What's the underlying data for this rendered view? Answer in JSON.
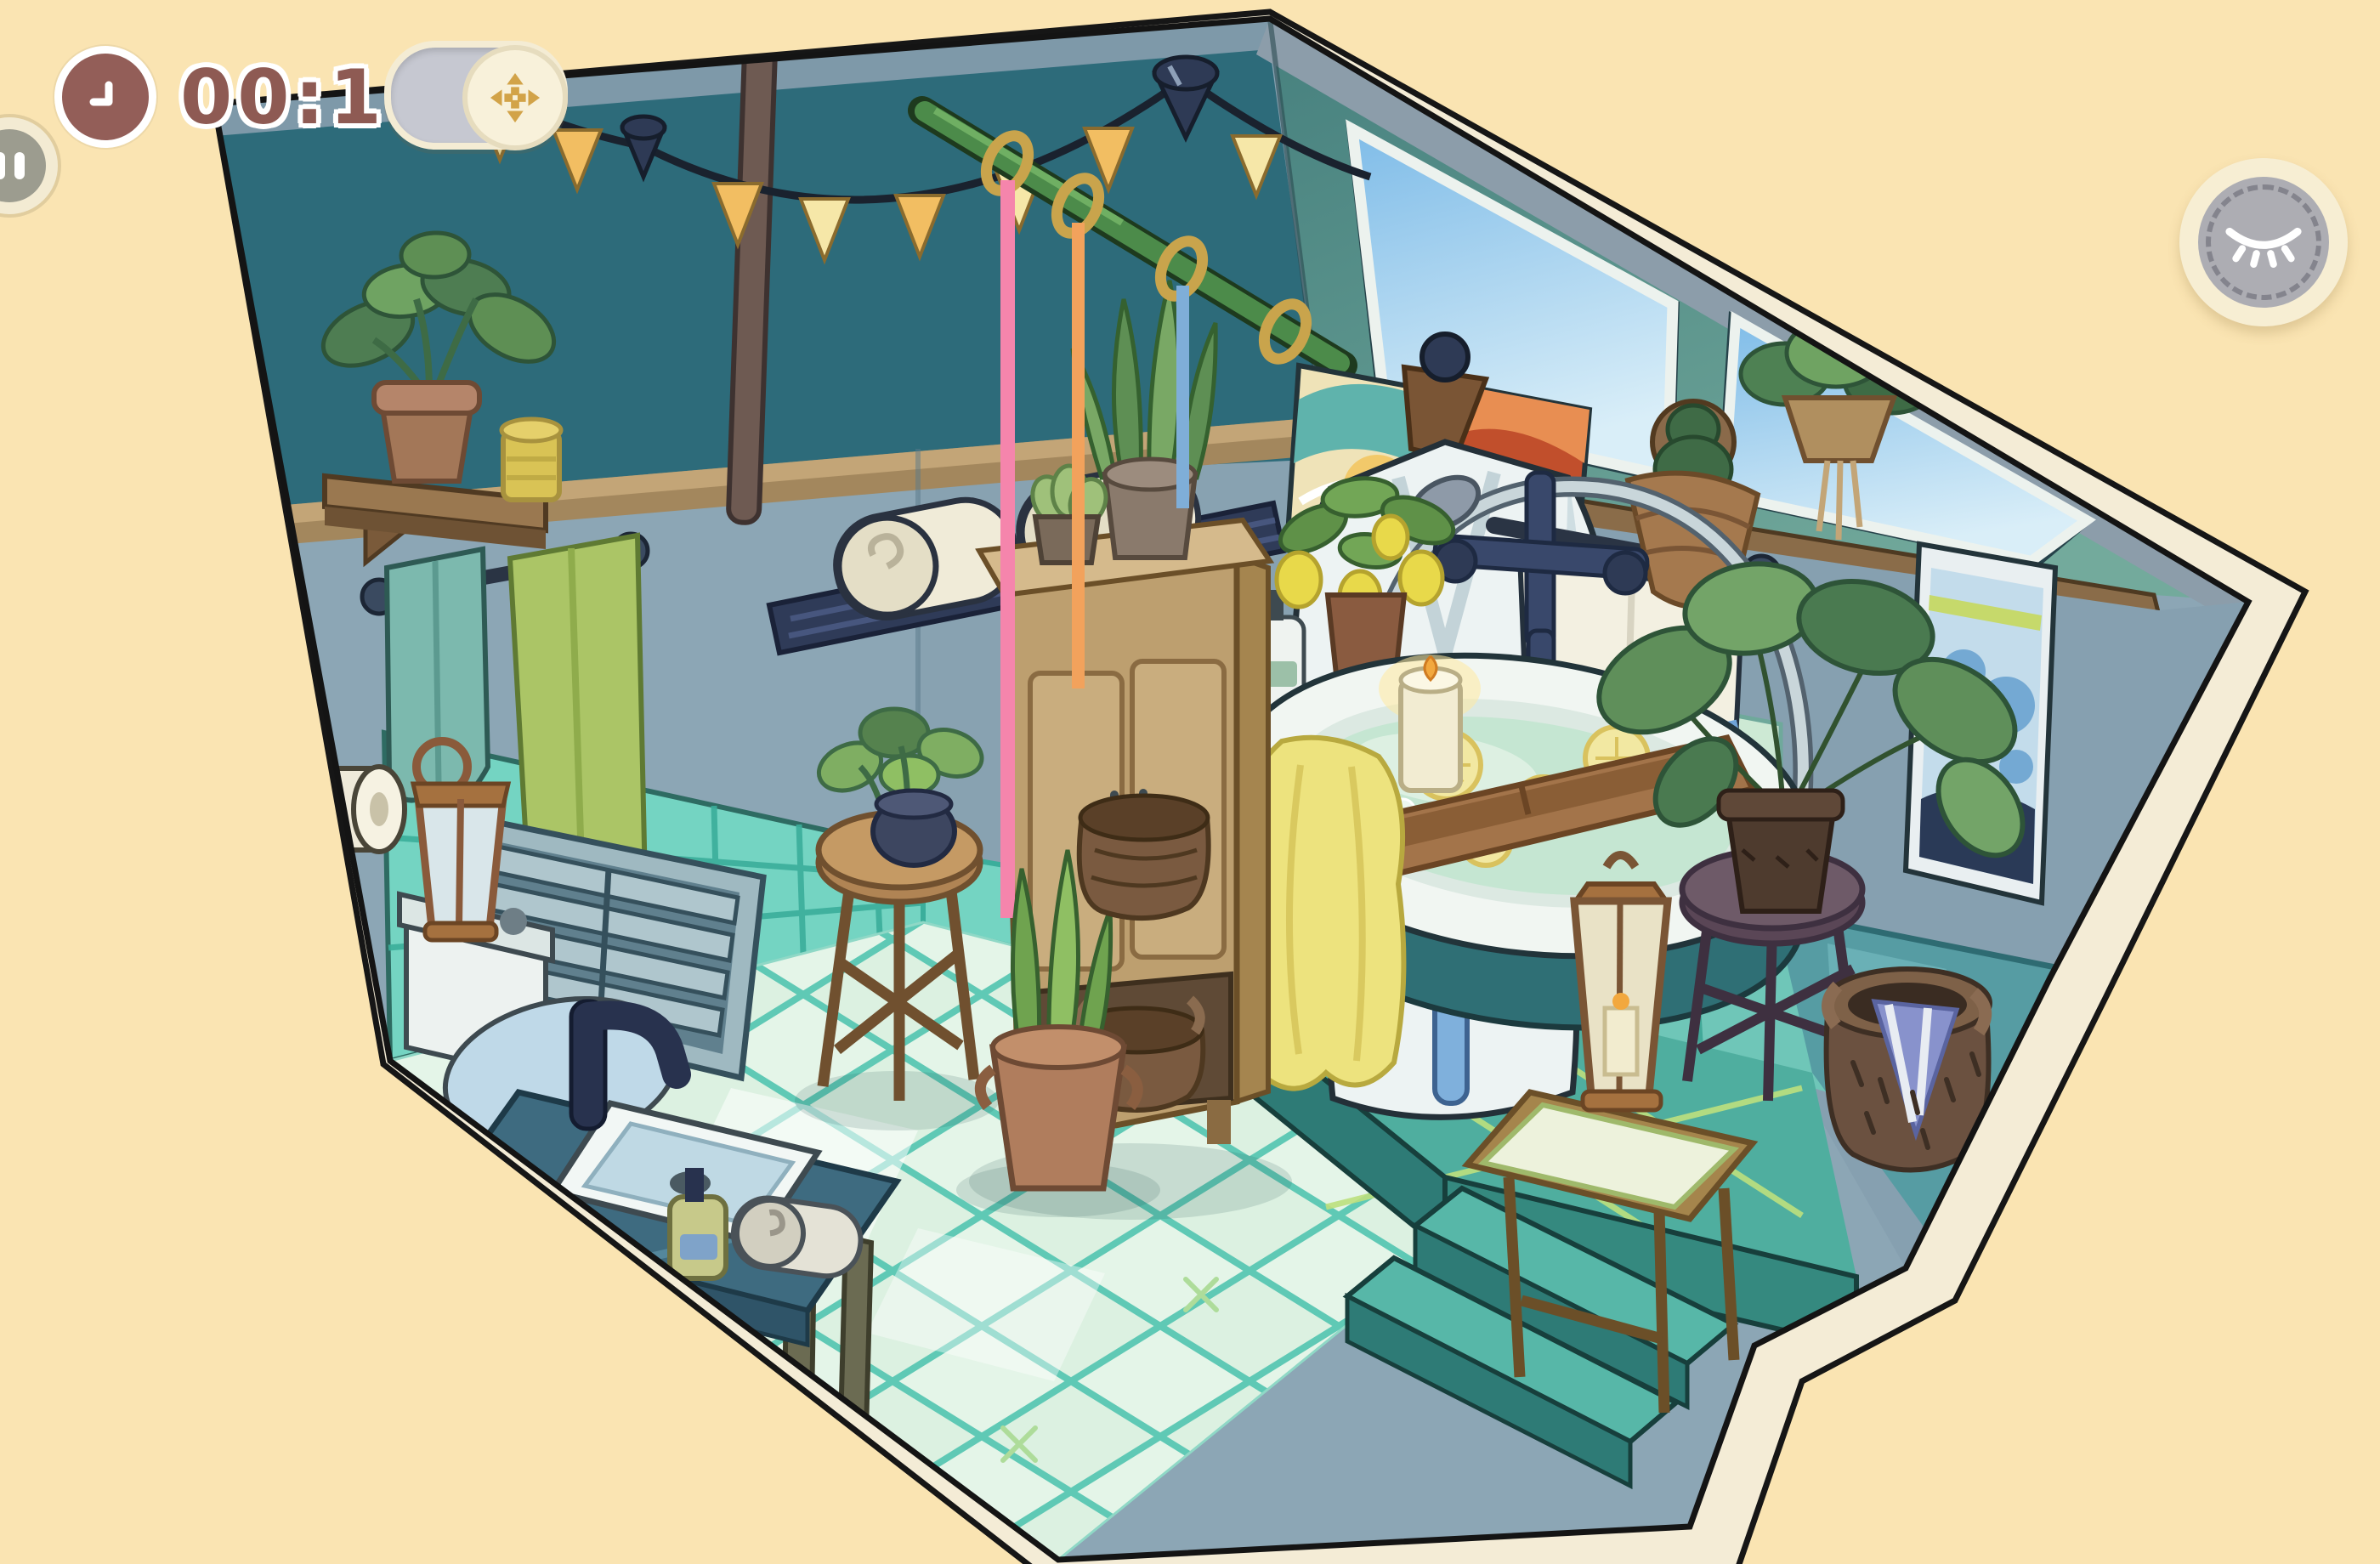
{
  "hud": {
    "timer": {
      "label": "00:18",
      "icon": "clock-icon"
    },
    "move_toggle": {
      "icon": "move-arrows-icon",
      "state_on": true
    },
    "pause_button": {
      "icon": "pause-icon"
    },
    "hide_button": {
      "icon": "closed-eye-icon"
    }
  },
  "scene": {
    "name": "attic-bathroom-room",
    "background_color": "#FAE4B2",
    "room_border_color": "#F4ECD6",
    "palette": {
      "wall_upper_teal": "#2D6B7A",
      "wall_top_strip": "#7E99A9",
      "wall_lower_bluegrey": "#8CA6B5",
      "molding_tan": "#A3875D",
      "ceiling_slope_teal": "#4F8A86",
      "roof_band_grey": "#8C9DAA",
      "skylight_sky_blue": "#9CCDEE",
      "beam_brown": "#8A6C49",
      "wainscot_tile_teal": "#74D4C2",
      "floor_mint": "#DCF1E1",
      "floor_grout": "#5FC9B5",
      "platform_teal": "#4FAE9F",
      "platform_front_dark": "#2E7B76",
      "ribbon_pink": "#F585AC",
      "ribbon_orange": "#F2A25C",
      "ribbon_blue": "#7FAED8",
      "flag_gold": "#F2BE62",
      "flag_cream": "#F6E7A8",
      "towel_yellow": "#EDE37E",
      "water_mint": "#C5E6D2"
    },
    "objects": [
      "flag-garland",
      "ceiling-pipe",
      "ribbon-rod",
      "wall-shelf-plant",
      "storage-jar",
      "towel-bar",
      "rolled-towels-rack",
      "bathrobe",
      "toilet-paper-holder",
      "wall-vent",
      "abstract-painting-teal",
      "abstract-painting-red",
      "storage-cabinet",
      "cabinet-snake-plant",
      "cabinet-succulent",
      "cabinet-basket",
      "plant-stool",
      "stool-plant",
      "floor-snake-plant",
      "wicker-basket",
      "toilet",
      "toilet-lantern",
      "sink-vanity",
      "soap-dispenser",
      "rolled-hand-towel",
      "skylight-window-left",
      "skylight-window-right",
      "hanging-plant",
      "wall-cactus-basket",
      "ink-painting",
      "striped-towel-rail",
      "lemon-plant",
      "soap-bottles",
      "shower-set",
      "bathtub",
      "bath-water-lemons",
      "yellow-bath-towel",
      "bath-caddy",
      "bath-candle",
      "bath-mat",
      "large-potted-plant",
      "purple-stool",
      "laundry-basket",
      "lantern-side-table",
      "platform-steps"
    ]
  }
}
